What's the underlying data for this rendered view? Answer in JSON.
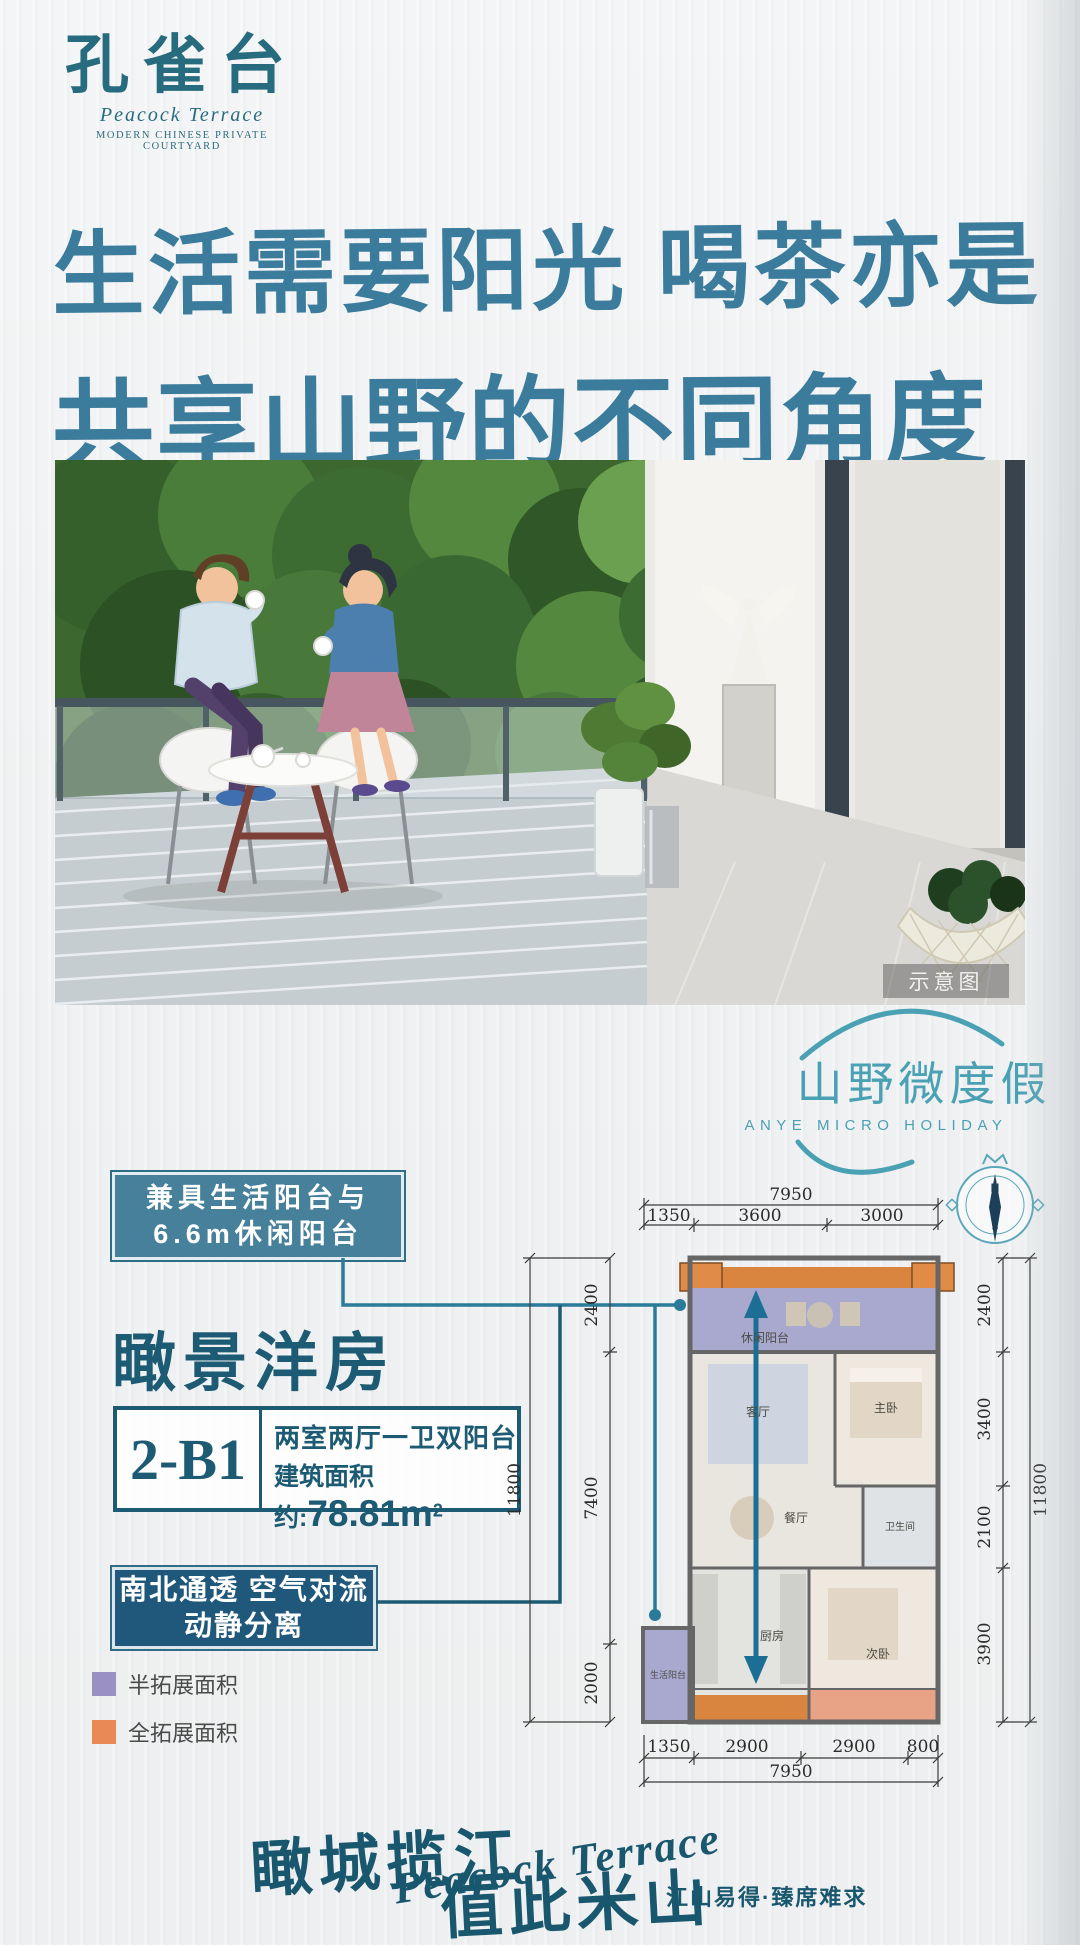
{
  "brand": {
    "logo_cn": "孔雀台",
    "logo_en": "Peacock Terrace",
    "logo_sub": "MODERN CHINESE PRIVATE COURTYARD"
  },
  "headline": {
    "line1": "生活需要阳光 喝茶亦是",
    "line2": "共享山野的不同角度"
  },
  "photo": {
    "watermark": "示意图"
  },
  "holiday": {
    "cn": "山野微度假",
    "en": "SHANYE MICRO HOLIDAY",
    "accent_color": "#4ba1b4"
  },
  "callouts": {
    "balcony": {
      "line1": "兼具生活阳台与",
      "line2": "6.6m休闲阳台",
      "bg": "#47809b"
    },
    "vent": {
      "line1": "南北通透  空气对流",
      "line2": "动静分离",
      "bg": "#1f587a"
    }
  },
  "unit": {
    "title": "瞰景洋房",
    "code": "2-B1",
    "layout": "两室两厅一卫双阳台",
    "area_label": "建筑面积约:",
    "area_value": "78.81m",
    "area_sup": "2",
    "accent_color": "#1d5b74"
  },
  "legend": [
    {
      "label": "半拓展面积",
      "color": "#9a90c2"
    },
    {
      "label": "全拓展面积",
      "color": "#e98a56"
    }
  ],
  "floorplan": {
    "compass_n": "N",
    "compass_s": "S",
    "dims_top_total": "7950",
    "dims_top": [
      "1350",
      "3600",
      "3000"
    ],
    "dims_left_total": "11800",
    "dims_left": [
      "2400",
      "7400",
      "2000"
    ],
    "dims_right_total": "11800",
    "dims_right": [
      "2400",
      "3400",
      "2100",
      "3900"
    ],
    "dims_bottom": [
      "1350",
      "2900",
      "2900",
      "800"
    ],
    "dims_bottom_total": "7950",
    "rooms": {
      "leisure_balcony": "休闲阳台",
      "living": "客厅",
      "master": "主卧",
      "bath": "卫生间",
      "dining": "餐厅",
      "kitchen": "厨房",
      "second": "次卧",
      "service_balcony": "生活阳台"
    }
  },
  "footer": {
    "slogan1": "瞰城揽江",
    "slogan2": "值此米山",
    "slogan_en": "Peacock Terrace",
    "tagline": "江山易得·臻席难求"
  }
}
